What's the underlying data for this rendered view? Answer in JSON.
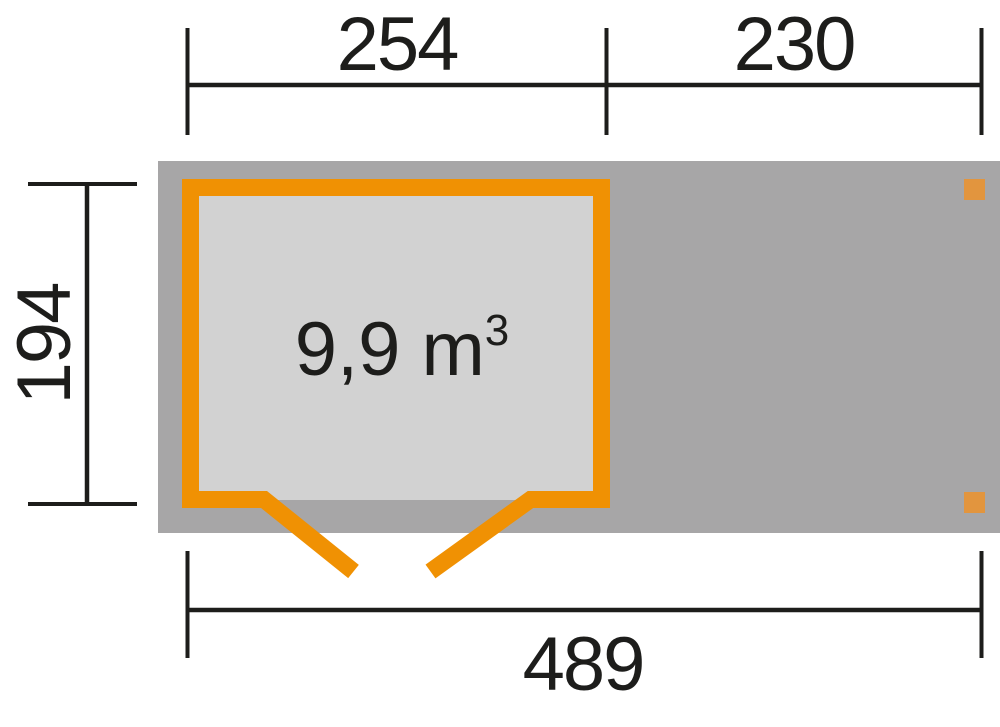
{
  "plan": {
    "dimensions": {
      "top_left": "254",
      "top_right": "230",
      "left": "194",
      "bottom": "489"
    },
    "room": {
      "volume_value": "9,9 m",
      "volume_exponent": "3"
    }
  },
  "colors": {
    "background": "#ffffff",
    "roof_footprint": "#a7a6a7",
    "interior_floor": "#d2d2d2",
    "wall_orange": "#f09103",
    "post_orange": "#e2953e",
    "dimension_black": "#1d1d1b"
  }
}
